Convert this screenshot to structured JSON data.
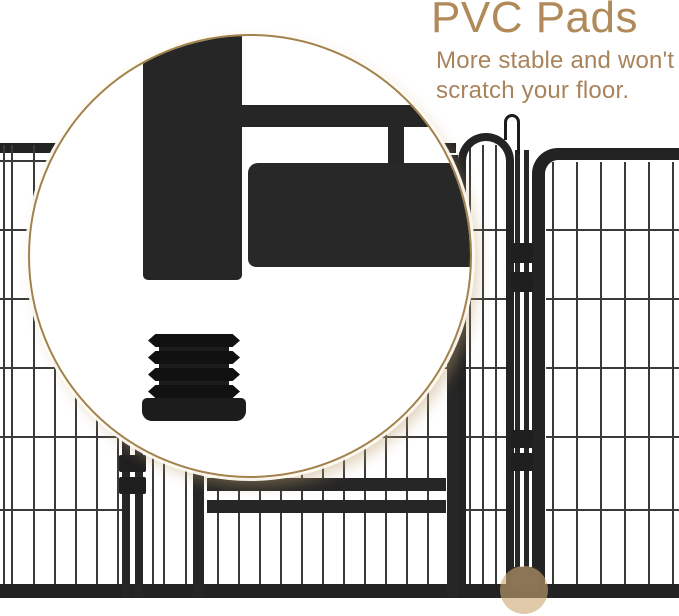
{
  "callout": {
    "title": "PVC Pads",
    "subtitle": "More stable and won't scratch your floor."
  },
  "colors": {
    "title_tan": "#b18a5a",
    "subtitle_tan": "#a8845c",
    "magnifier_border_tan": "#a2824d",
    "highlight_tan": "rgba(205,167,114,0.6)",
    "frame_black": "#232323",
    "wire_gray": "#3a3a3a",
    "pad_black": "#1c1c1c",
    "background": "#ffffff"
  },
  "icons": {
    "magnifier_callout": "zoom-circle-icon",
    "pad_highlight": "highlight-dot-icon"
  }
}
